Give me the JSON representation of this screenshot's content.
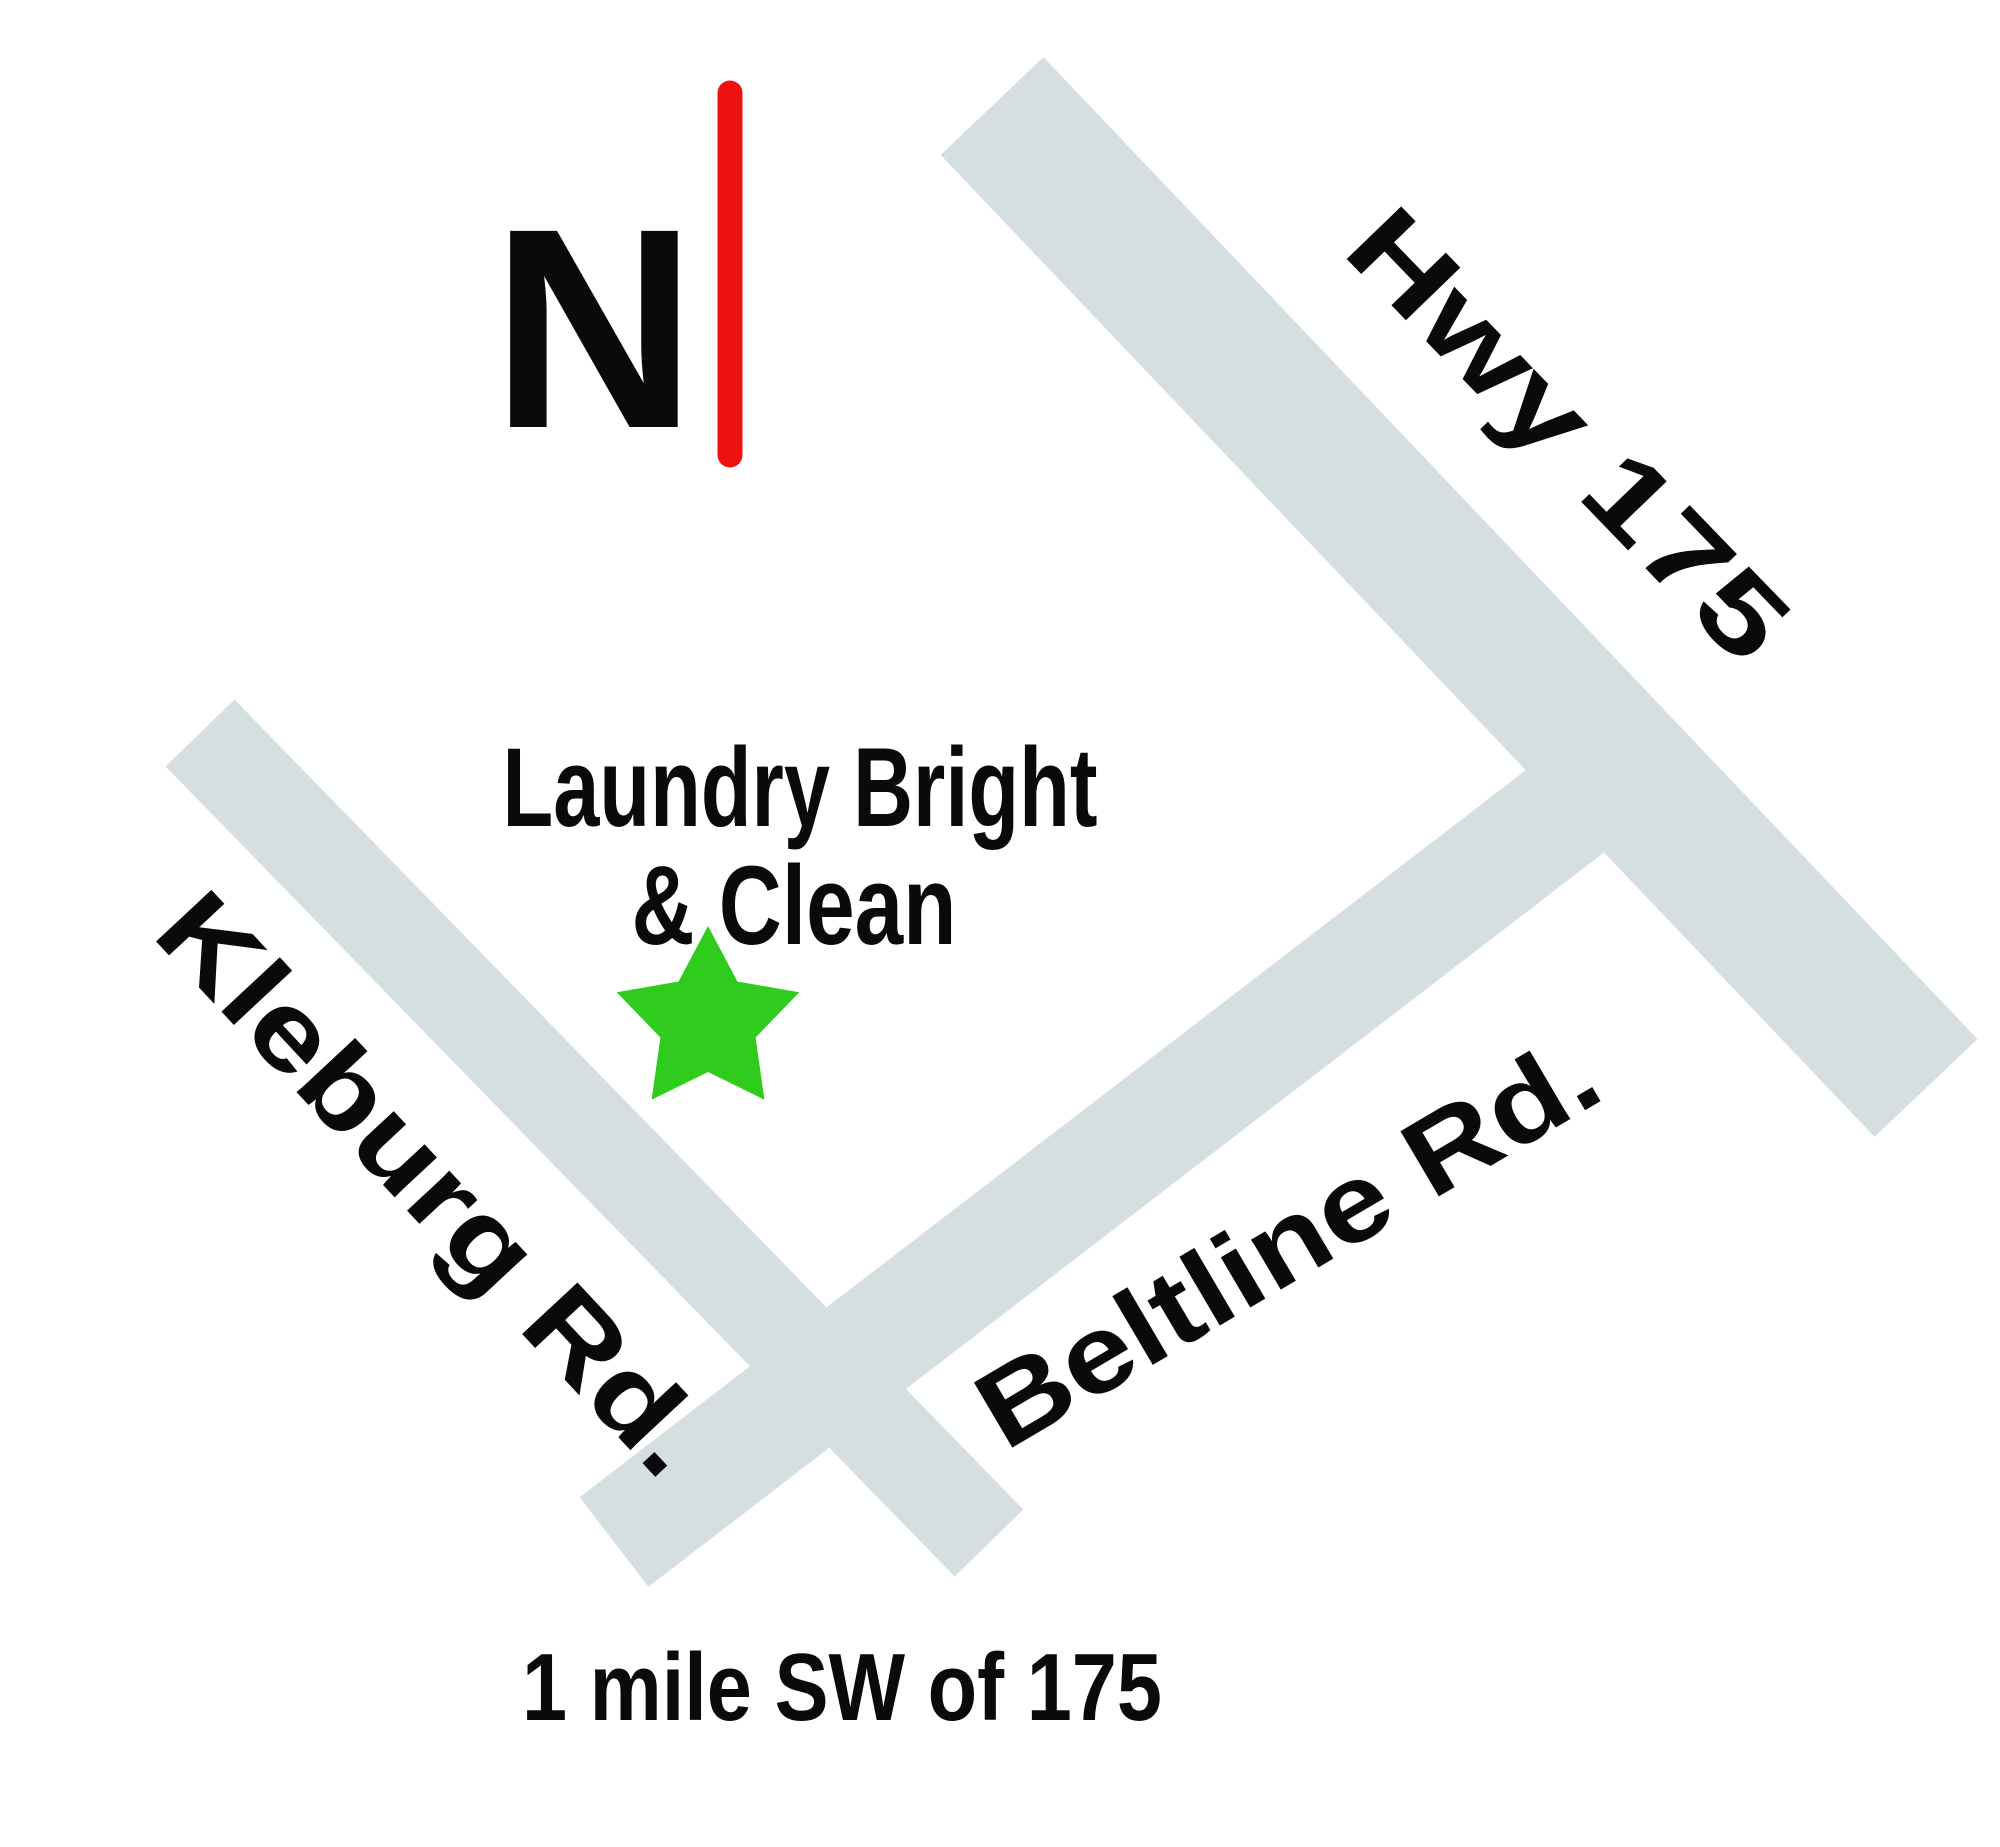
{
  "map": {
    "background_color": "#ffffff",
    "road_color": "#d5dfe2",
    "text_color": "#0a0a0a",
    "compass": {
      "label": "N",
      "needle_color": "#ee1111"
    },
    "roads": [
      {
        "name": "Hwy 175"
      },
      {
        "name": "Kleburg Rd."
      },
      {
        "name": "Beltline Rd."
      }
    ],
    "marker": {
      "label_line1": "Laundry Bright",
      "label_line2": "& Clean",
      "color": "#2fcc1e",
      "shape": "star-5",
      "cx": 708,
      "cy": 1022,
      "outer_radius": 96,
      "inner_radius": 50
    },
    "footnote": "1 mile SW of 175"
  }
}
